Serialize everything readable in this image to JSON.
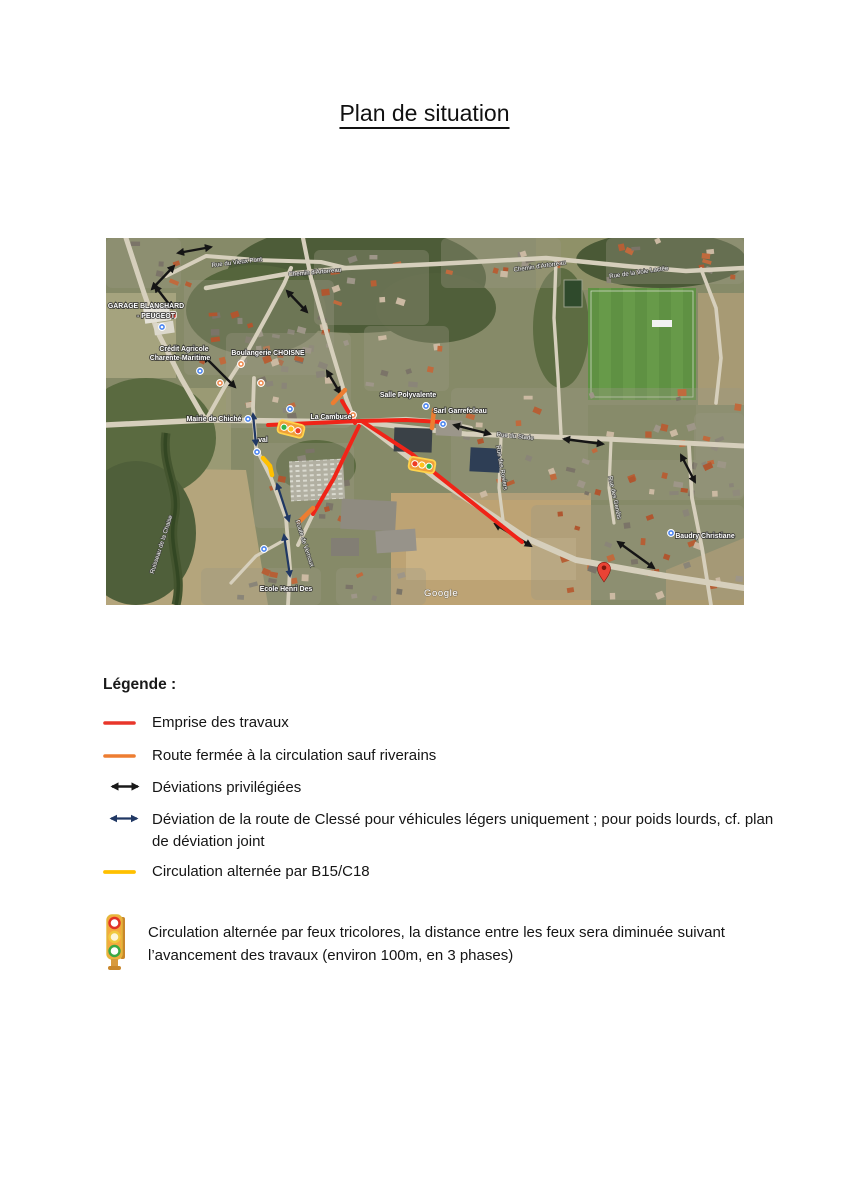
{
  "page": {
    "title": "Plan de situation"
  },
  "map": {
    "watermark": "Google",
    "colors": {
      "works_red": "#f02418",
      "closed_orange": "#ed7d31",
      "deviation_black": "#151515",
      "deviation_vl_blue": "#203864",
      "alternating_yellow": "#ffc000",
      "poi_blue": "#4a84f0",
      "poi_orange": "#ef8a4e",
      "pin_red": "#ea4335"
    },
    "labels": [
      {
        "text": "GARAGE BLANCHARD",
        "x": 40,
        "y": 70,
        "cls": "place"
      },
      {
        "text": "- PEUGEOT",
        "x": 50,
        "y": 80,
        "cls": "place"
      },
      {
        "text": "Crédit Agricole",
        "x": 78,
        "y": 113,
        "cls": "place"
      },
      {
        "text": "Charente-Maritime",
        "x": 74,
        "y": 122,
        "cls": "place"
      },
      {
        "text": "Boulangerie CHOISNE",
        "x": 162,
        "y": 117,
        "cls": "place"
      },
      {
        "text": "Salle Polyvalente",
        "x": 302,
        "y": 159,
        "cls": "place"
      },
      {
        "text": "Sarl Garrefoleau",
        "x": 354,
        "y": 175,
        "cls": "place"
      },
      {
        "text": "La Cambuse",
        "x": 225,
        "y": 181,
        "cls": "place"
      },
      {
        "text": "Mairie de Chiché",
        "x": 108,
        "y": 183,
        "cls": "place"
      },
      {
        "text": "val",
        "x": 157,
        "y": 204,
        "cls": "place"
      },
      {
        "text": "Ecole Henri Des",
        "x": 180,
        "y": 353,
        "cls": "place"
      },
      {
        "text": "Baudry Christiane",
        "x": 599,
        "y": 300,
        "cls": "place"
      },
      {
        "text": "Rue du Vieux Pont",
        "x": 131,
        "y": 26,
        "rot": -7,
        "cls": "road"
      },
      {
        "text": "Chemin d'Artorreau",
        "x": 209,
        "y": 36,
        "rot": -5,
        "cls": "road"
      },
      {
        "text": "Chemin d'Artorreau",
        "x": 434,
        "y": 30,
        "rot": -8,
        "cls": "road"
      },
      {
        "text": "Rue de la Voie Lactée",
        "x": 533,
        "y": 36,
        "rot": -8,
        "cls": "road"
      },
      {
        "text": "Rue du Stade",
        "x": 409,
        "y": 200,
        "rot": 6,
        "cls": "road"
      },
      {
        "text": "Rue des Rosiers",
        "x": 394,
        "y": 230,
        "rot": 80,
        "cls": "road"
      },
      {
        "text": "Rue des Genêts",
        "x": 507,
        "y": 260,
        "rot": 78,
        "cls": "road"
      },
      {
        "text": "Route de Vernoux",
        "x": 197,
        "y": 306,
        "rot": 72,
        "cls": "road"
      },
      {
        "text": "Ruisseau de la Chaise",
        "x": 57,
        "y": 307,
        "rot": -72,
        "cls": "road"
      }
    ],
    "pois": [
      {
        "x": 56,
        "y": 89,
        "c": "#4a84f0"
      },
      {
        "x": 67,
        "y": 77,
        "c": "#d43b2d",
        "shape": "sq"
      },
      {
        "x": 94,
        "y": 133,
        "c": "#4a84f0"
      },
      {
        "x": 135,
        "y": 126,
        "c": "#ef8a4e"
      },
      {
        "x": 114,
        "y": 145,
        "c": "#ef8a4e"
      },
      {
        "x": 155,
        "y": 145,
        "c": "#ef8a4e"
      },
      {
        "x": 142,
        "y": 181,
        "c": "#4a84f0"
      },
      {
        "x": 151,
        "y": 214,
        "c": "#4a84f0"
      },
      {
        "x": 184,
        "y": 171,
        "c": "#4a84f0"
      },
      {
        "x": 247,
        "y": 177,
        "c": "#ef8a4e"
      },
      {
        "x": 320,
        "y": 168,
        "c": "#4a84f0"
      },
      {
        "x": 337,
        "y": 186,
        "c": "#4a84f0"
      },
      {
        "x": 158,
        "y": 311,
        "c": "#4a84f0"
      },
      {
        "x": 565,
        "y": 295,
        "c": "#4a84f0"
      }
    ],
    "annotations": {
      "red_lines": [
        [
          [
            162,
            187
          ],
          [
            254,
            183
          ]
        ],
        [
          [
            254,
            183
          ],
          [
            300,
            182
          ],
          [
            336,
            184
          ]
        ],
        [
          [
            249,
            185
          ],
          [
            236,
            163
          ]
        ],
        [
          [
            257,
            184
          ],
          [
            306,
            216
          ],
          [
            330,
            236
          ],
          [
            416,
            304
          ]
        ],
        [
          [
            253,
            188
          ],
          [
            240,
            215
          ],
          [
            228,
            240
          ],
          [
            207,
            276
          ]
        ]
      ],
      "orange_segments": [
        [
          [
            227,
            165
          ],
          [
            239,
            152
          ]
        ],
        [
          [
            328,
            172
          ],
          [
            326,
            190
          ]
        ],
        [
          [
            193,
            284
          ],
          [
            207,
            270
          ]
        ]
      ],
      "yellow_segments": [
        [
          [
            157,
            220
          ],
          [
            164,
            228
          ],
          [
            166,
            237
          ]
        ]
      ],
      "black_arrows": [
        [
          [
            72,
            15
          ],
          [
            105,
            9
          ]
        ],
        [
          [
            46,
            51
          ],
          [
            68,
            28
          ]
        ],
        [
          [
            49,
            48
          ],
          [
            66,
            70
          ]
        ],
        [
          [
            181,
            53
          ],
          [
            201,
            74
          ]
        ],
        [
          [
            98,
            118
          ],
          [
            129,
            149
          ]
        ],
        [
          [
            221,
            133
          ],
          [
            234,
            155
          ]
        ],
        [
          [
            348,
            187
          ],
          [
            384,
            196
          ]
        ],
        [
          [
            458,
            201
          ],
          [
            497,
            206
          ]
        ],
        [
          [
            575,
            217
          ],
          [
            589,
            244
          ]
        ],
        [
          [
            389,
            286
          ],
          [
            425,
            308
          ]
        ],
        [
          [
            512,
            304
          ],
          [
            548,
            330
          ]
        ]
      ],
      "blue_arrows": [
        [
          [
            147,
            176
          ],
          [
            150,
            207
          ]
        ],
        [
          [
            171,
            246
          ],
          [
            183,
            283
          ]
        ],
        [
          [
            178,
            297
          ],
          [
            184,
            338
          ]
        ]
      ],
      "traffic_lights": [
        {
          "x": 185,
          "y": 191,
          "rot": 14,
          "lights": [
            "#31b44b",
            "#ffc21d",
            "#ef3b24"
          ]
        },
        {
          "x": 316,
          "y": 227,
          "rot": 10,
          "lights": [
            "#ef3b24",
            "#ffc21d",
            "#31b44b"
          ]
        }
      ],
      "pin": {
        "x": 498,
        "y": 336
      }
    }
  },
  "legend": {
    "heading": "Légende :",
    "items": [
      {
        "symbol": "red-line",
        "label": "Emprise des travaux"
      },
      {
        "symbol": "orange-line",
        "label": "Route fermée à la circulation sauf riverains"
      },
      {
        "symbol": "black-double-arrow",
        "label": "Déviations privilégiées"
      },
      {
        "symbol": "blue-double-arrow",
        "label": "Déviation de la route de Clessé pour véhicules légers uniquement ; pour poids lourds, cf. plan de déviation joint"
      },
      {
        "symbol": "yellow-line",
        "label": "Circulation alternée par B15/C18"
      },
      {
        "symbol": "traffic-light",
        "label": " Circulation alternée par feux tricolores, la distance entre les feux sera diminuée suivant l’avancement des travaux (environ 100m, en 3 phases)"
      }
    ]
  }
}
